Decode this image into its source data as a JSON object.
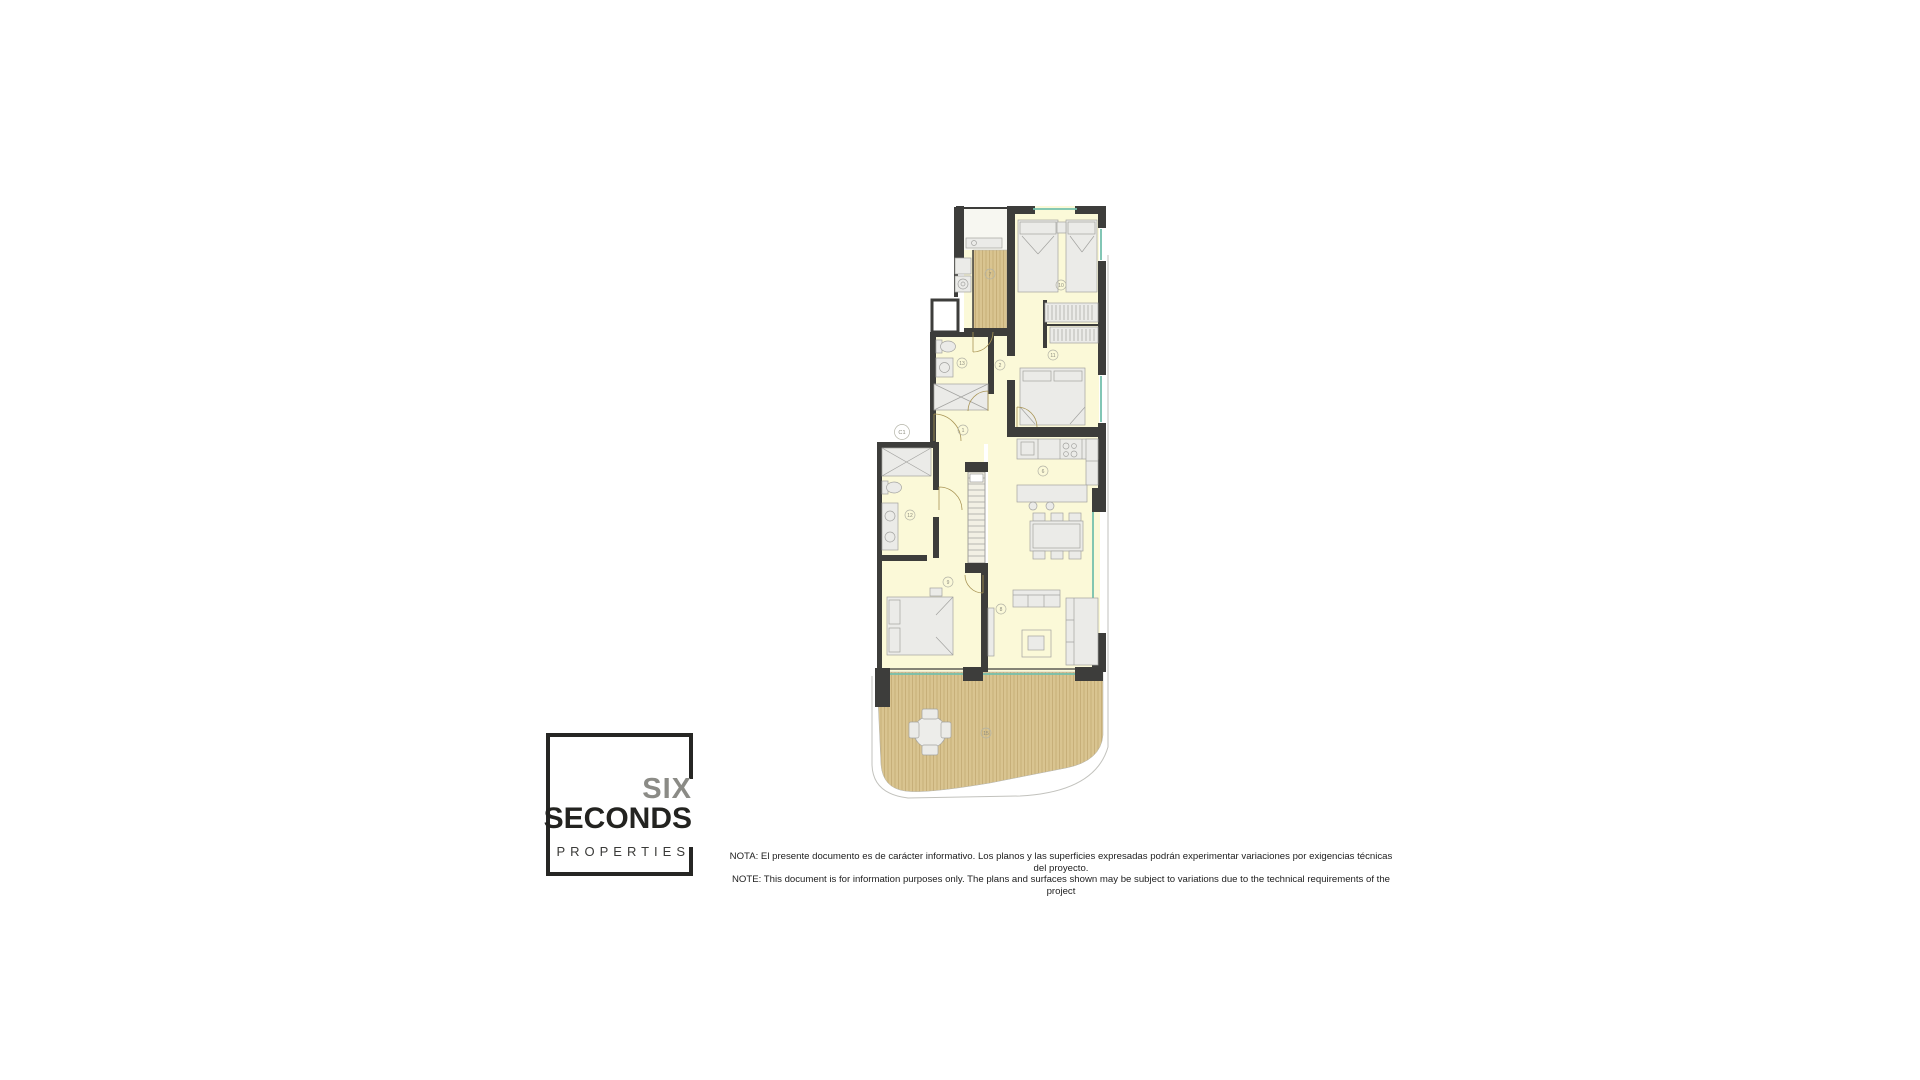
{
  "logo": {
    "line1": "SIX",
    "line2": "SECONDS",
    "line3": "PROPERTIES"
  },
  "disclaimer": {
    "line1": "NOTA: El presente documento es de carácter informativo. Los planos y las superficies expresadas podrán experimentar variaciones por exigencias técnicas del proyecto.",
    "line2": "NOTE: This document is for information purposes only. The plans and surfaces shown may be subject to variations due to the technical requirements of the project"
  },
  "plan": {
    "unit_label": "C1",
    "labels": [
      {
        "room": "utility-terrace",
        "text": "7"
      },
      {
        "room": "bedroom-top",
        "text": "10"
      },
      {
        "room": "bedroom-middle",
        "text": "11"
      },
      {
        "room": "bathroom-top",
        "text": "13"
      },
      {
        "room": "corridor",
        "text": "2"
      },
      {
        "room": "hall",
        "text": "1"
      },
      {
        "room": "bathroom-ensuite",
        "text": "12"
      },
      {
        "room": "kitchen",
        "text": "6"
      },
      {
        "room": "bedroom-main",
        "text": "9"
      },
      {
        "room": "living-room",
        "text": "8"
      },
      {
        "room": "terrace",
        "text": "15"
      }
    ],
    "colors": {
      "wall": "#3d3d3b",
      "room_fill": "#fbf9d8",
      "terrace_fill": "#d9c490",
      "terrace_stripe": "#c3aa73",
      "window": "#74c0ad",
      "furniture": "#ebebe8"
    }
  }
}
